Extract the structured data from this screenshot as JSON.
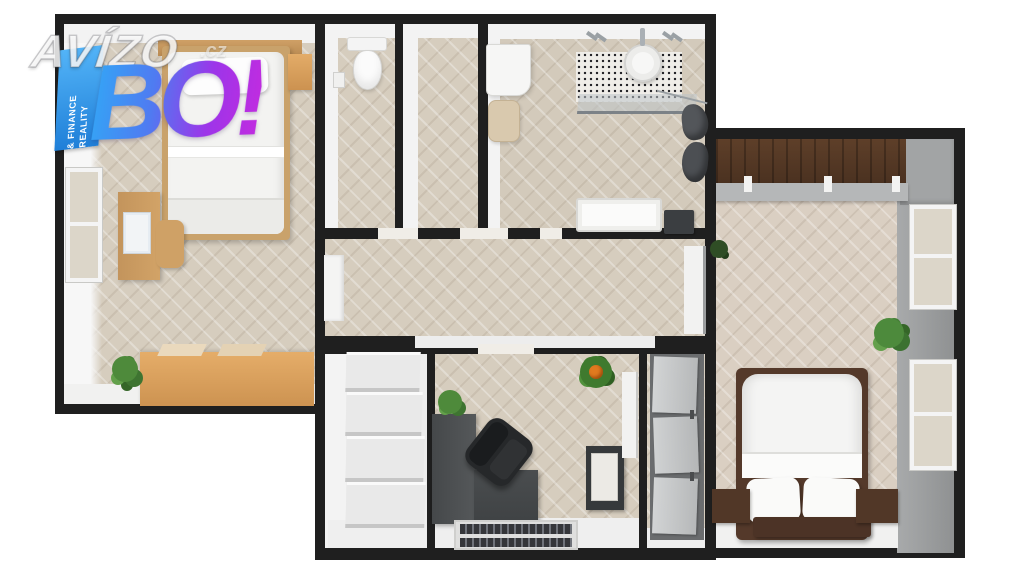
{
  "image_type": "3D top-down floor plan render with real-estate watermark",
  "watermark": {
    "brand": "AVÍZO",
    "domain_suffix": ".cz",
    "badge": "BO!",
    "ribbon_line1": "REALITY",
    "ribbon_line2": "& FINANCE",
    "colors": {
      "badge_gradient_start": "#33a6f6",
      "badge_gradient_end": "#c02ce0",
      "ribbon_blue": "#2b93ea",
      "brand_text": "#ffffff"
    }
  },
  "floorplan": {
    "background": "#ffffff",
    "colors": {
      "walls": "#1f1f1f",
      "floor_wood": "#d6cdbe",
      "inner_walls": "#f3f3f3",
      "dark_wood": "#55392a",
      "light_oak": "#dca76a",
      "grey_wall": "#9c9ea0",
      "plant_green": "#4e8a3b",
      "desk_dark": "#4a4d4f",
      "towel_grey": "#515458"
    },
    "rooms": [
      {
        "id": "bedroom-left",
        "name": "Bedroom (left)",
        "furniture": [
          "double bed with white duvet and pillow",
          "wood headboard shelf",
          "nightstand",
          "wood desk with laptop",
          "desk chair",
          "window in left wall",
          "light oak sideboard",
          "potted plant"
        ]
      },
      {
        "id": "wc",
        "name": "WC",
        "furniture": [
          "wall-hung toilet",
          "toilet paper holder"
        ]
      },
      {
        "id": "empty-room",
        "name": "Narrow empty room",
        "furniture": []
      },
      {
        "id": "bathroom",
        "name": "Bathroom",
        "furniture": [
          "washing machine",
          "laundry basket",
          "black dotted tile splashback",
          "round washbasin",
          "chrome faucets",
          "glass shelf",
          "two dark grey towels",
          "bathtub",
          "dark waste bin"
        ]
      },
      {
        "id": "hallway",
        "name": "Hallway",
        "furniture": [
          "wall niche",
          "door opening to right bedroom",
          "small potted plant"
        ]
      },
      {
        "id": "staircase",
        "name": "Staircase",
        "furniture": [
          "white stairs, four treads and landing"
        ]
      },
      {
        "id": "office-entry",
        "name": "Office / entry room",
        "furniture": [
          "L-shaped dark desk",
          "black office chair",
          "desk plant",
          "flowering plant",
          "dark cabinet with white front",
          "striped double doormat"
        ]
      },
      {
        "id": "wardrobe",
        "name": "Built-in wardrobe column",
        "furniture": [
          "three grey sliding door panels with handles"
        ]
      },
      {
        "id": "bedroom-right",
        "name": "Bedroom (right)",
        "furniture": [
          "dark wood wall panel",
          "grey shelf with three candles",
          "double bed with white duvet and two pillows",
          "dark wood footboard",
          "two nightstands",
          "two windows in grey right wall",
          "potted plant"
        ]
      }
    ]
  }
}
